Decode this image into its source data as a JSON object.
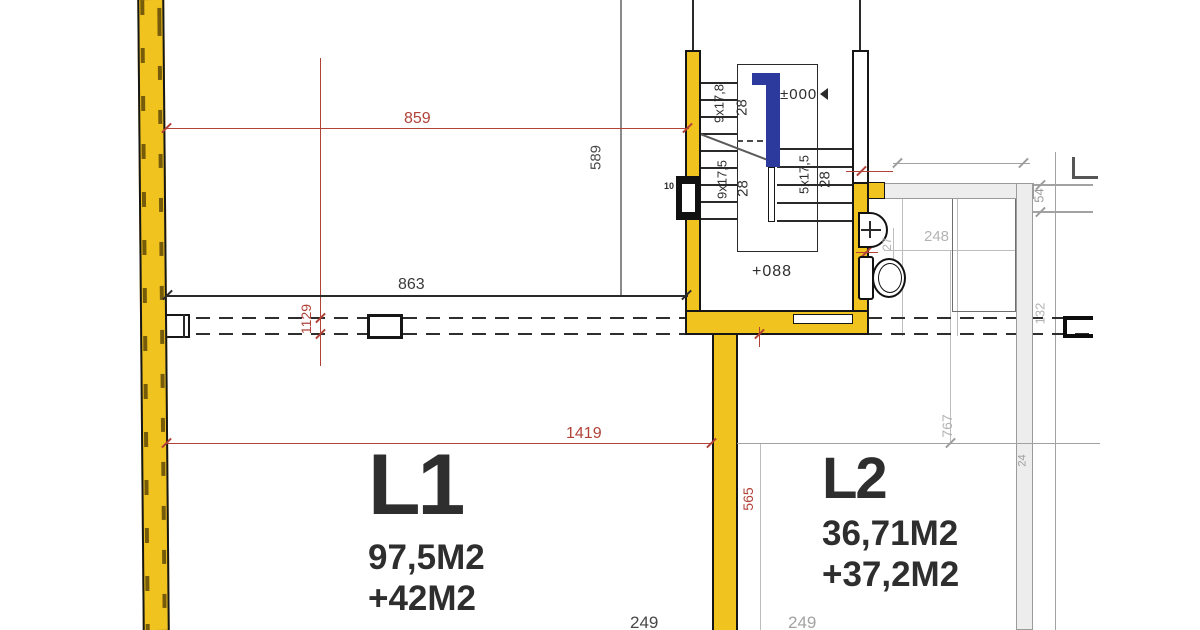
{
  "units": {
    "l1": {
      "label": "L1",
      "area": "97,5M2",
      "bonus": "+42M2",
      "color": "#1787d1"
    },
    "l2": {
      "label": "L2",
      "area": "36,71M2",
      "bonus": "+37,2M2",
      "color": "#8ba1b4"
    }
  },
  "levels": {
    "ground": "±000",
    "landing": "+088"
  },
  "stair": {
    "flight_top": "9x17,8",
    "flight_top_tread": "28",
    "flight_mid": "9x17,5",
    "flight_mid_tread": "28",
    "flight_low": "5x17,5",
    "flight_low_tread": "28",
    "door_tag": "10"
  },
  "dims": {
    "d859": "859",
    "d863": "863",
    "d589": "589",
    "d1129": "1129",
    "d1419": "1419",
    "d565": "565",
    "d248": "248",
    "d27": "27",
    "d54": "54",
    "d132": "132",
    "d767": "767",
    "d24": "24",
    "d249_left": "249",
    "d249_right": "249"
  },
  "colors": {
    "wall_yellow": "#f1c31f",
    "dim_red": "#b04238",
    "rail_blue": "#2c3a9e",
    "secondary_gray": "#ededed"
  }
}
